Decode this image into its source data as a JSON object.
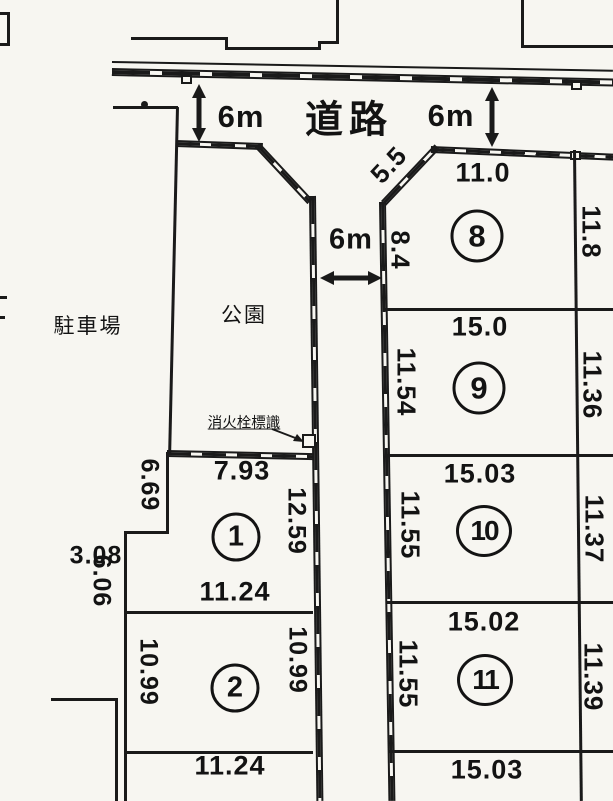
{
  "region_labels": {
    "road": "道路",
    "parking": "駐車場",
    "park": "公園",
    "fire_hydrant_sign": "消火栓標識"
  },
  "road_widths": {
    "top_left": "6m",
    "top_right": "6m",
    "center": "6m"
  },
  "plot_numbers": {
    "p1": "1",
    "p2": "2",
    "p8": "8",
    "p9": "9",
    "p10": "10",
    "p11": "11"
  },
  "dimensions": {
    "p8_corner": "5.5",
    "p8_top": "11.0",
    "p8_left": "8.4",
    "p8_right": "11.8",
    "p9_top": "15.0",
    "p9_left": "11.54",
    "p9_right": "11.36",
    "p10_top": "15.03",
    "p10_left": "11.55",
    "p10_right": "11.37",
    "p11_top": "15.02",
    "p11_left": "11.55",
    "p11_right": "11.39",
    "p11_bottom": "15.03",
    "p1_top": "7.93",
    "p1_left": "6.69",
    "p1_right": "12.59",
    "p1_step": "3.08",
    "p1_bottom": "11.24",
    "p2_left": "10.99",
    "p2_right": "10.99",
    "p2_bottom": "11.24",
    "west_side": "6.06"
  }
}
